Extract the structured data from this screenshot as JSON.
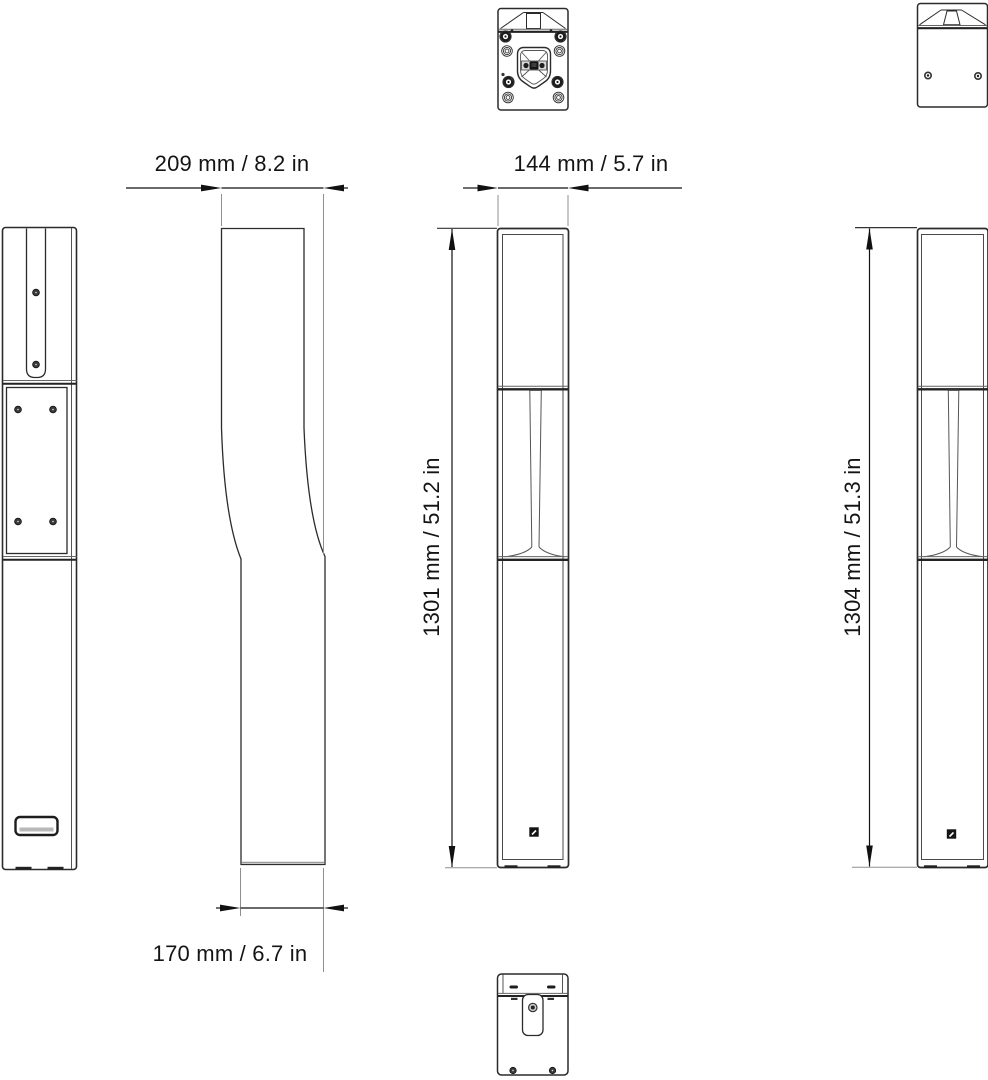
{
  "drawing": {
    "dimensions": {
      "top_depth": "209 mm / 8.2 in",
      "front_width": "144 mm / 5.7 in",
      "front_height": "1301 mm / 51.2 in",
      "rear_height": "1304 mm / 51.3 in",
      "bottom_depth": "170 mm / 6.7 in"
    },
    "colors": {
      "line": "#2b2b2b",
      "thin_line": "#555555",
      "extension_line": "#8f8f8f",
      "text": "#141414",
      "background": "#ffffff"
    }
  }
}
